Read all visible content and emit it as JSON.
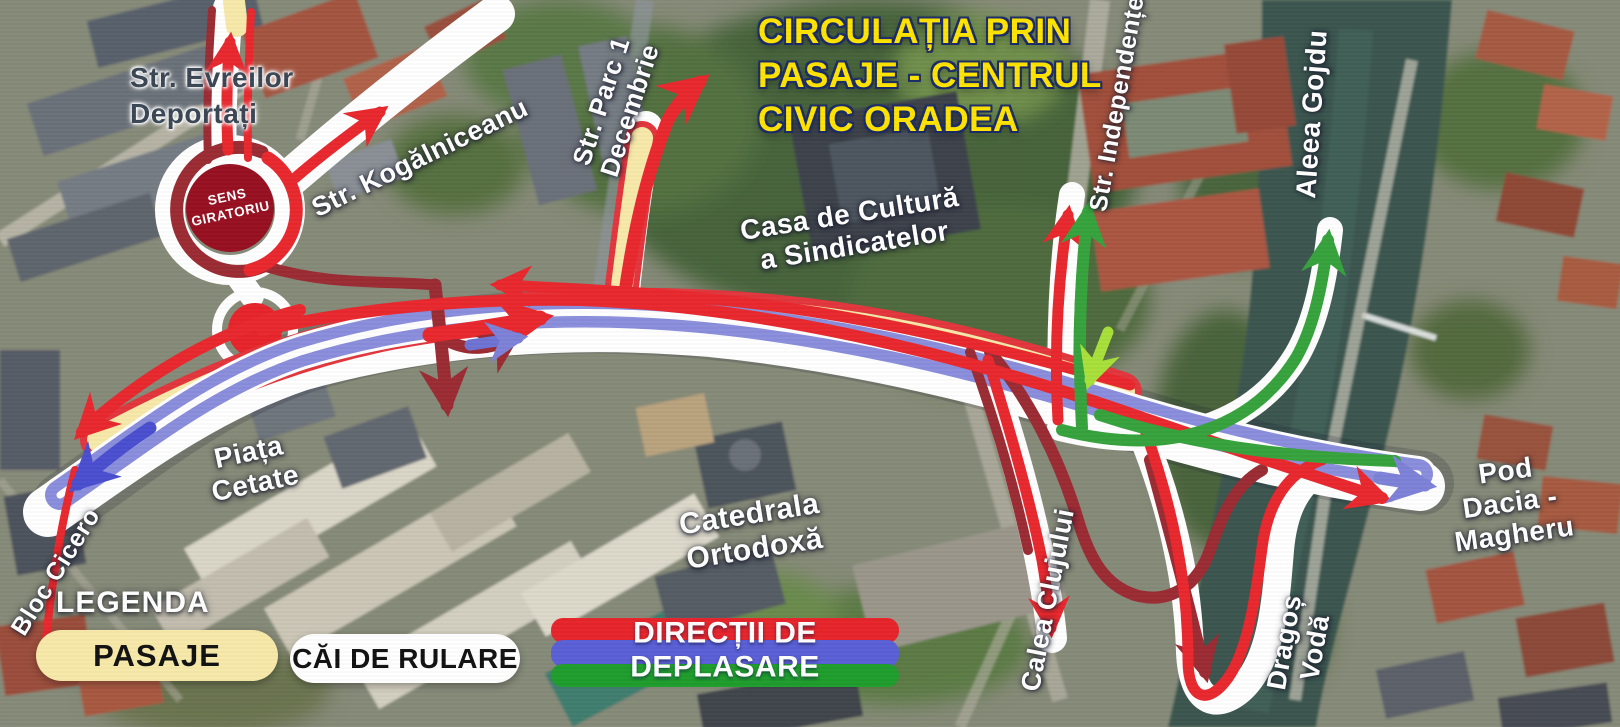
{
  "title": {
    "text": "CIRCULAȚIA PRIN\nPASAJE - CENTRUL\nCIVIC ORADEA"
  },
  "roundabout_label": {
    "text": "SENS\nGIRATORIU"
  },
  "labels": [
    {
      "name": "street-label-evreilor-deportati",
      "text": "Str. Evreilor\nDeportați"
    },
    {
      "name": "street-label-kogalniceanu",
      "text": "Str. Kogălniceanu"
    },
    {
      "name": "street-label-parc-1-decembrie",
      "text": "Str. Parc 1\nDecembrie"
    },
    {
      "name": "place-label-casa-de-cultura",
      "text": "Casa de Cultură\na Sindicatelor"
    },
    {
      "name": "street-label-independentei",
      "text": "Str. Independenței"
    },
    {
      "name": "street-label-aleea-gojdu",
      "text": "Aleea Gojdu"
    },
    {
      "name": "place-label-piata-cetate",
      "text": "Piața\nCetate"
    },
    {
      "name": "place-label-bloc-cicero",
      "text": "Bloc Cicero"
    },
    {
      "name": "place-label-catedrala-ortodoxa",
      "text": "Catedrala\nOrtodoxă"
    },
    {
      "name": "street-label-calea-clujului",
      "text": "Calea Clujului"
    },
    {
      "name": "street-label-dragos-voda",
      "text": "Dragoș\nVodă"
    },
    {
      "name": "place-label-pod-dacia-magheru",
      "text": "Pod Dacia -\nMagheru"
    }
  ],
  "legend": {
    "heading": "LEGENDA",
    "items": [
      {
        "label": "PASAJE",
        "bg": "#F7E9A9"
      },
      {
        "label": "CĂI DE RULARE",
        "bg": "#FFFFFF"
      },
      {
        "label": "DIRECȚII DE DEPLASARE",
        "stripes": [
          "#E8242B",
          "#5A5FD6",
          "#1F9D2C"
        ]
      }
    ]
  },
  "map": {
    "colors": {
      "pasaje_band": "#F7E9A9",
      "roadway_band": "#FFFFFF",
      "direction_red": "#E8282E",
      "direction_dark_red": "#9B2B33",
      "direction_blue": "#8A8EDC",
      "direction_indigo": "#4A4FD0",
      "direction_green": "#36A33C",
      "direction_lime": "#A8E03A",
      "roundabout_fill": "#970F20"
    }
  }
}
